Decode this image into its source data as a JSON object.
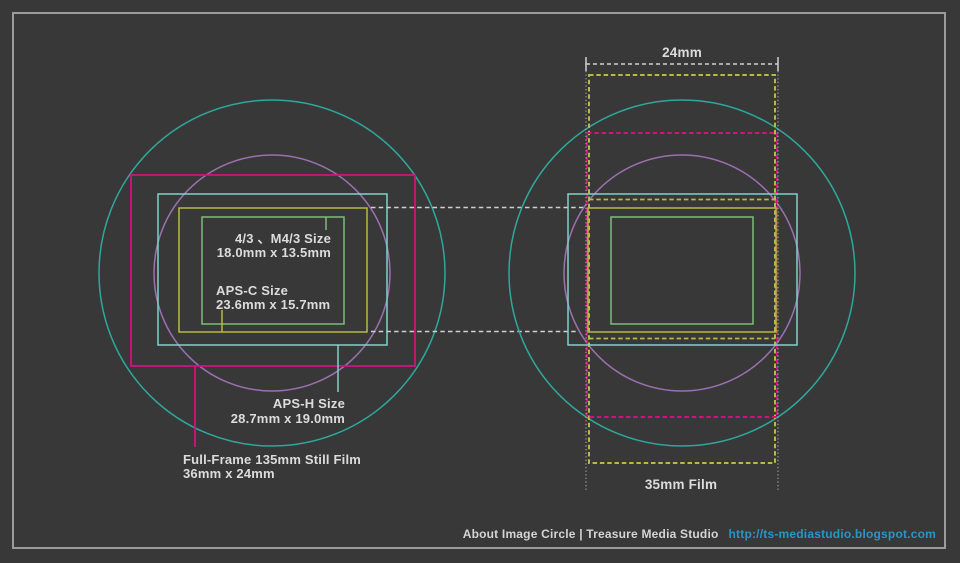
{
  "colors": {
    "background": "#383838",
    "frame": "#9b9b9b",
    "teal": "#2ea89c",
    "violet": "#9c6fb0",
    "magenta": "#d4107e",
    "cyan": "#7fd2c9",
    "yellow": "#b9b945",
    "green": "#7cbe78",
    "white_dash": "#d0d0d0",
    "dotted": "#b9b9b9",
    "text": "#dcdcdc",
    "link": "#2697c6"
  },
  "sensors": {
    "four_thirds": {
      "name": "4/3 、M4/3 Size",
      "size": "18.0mm x 13.5mm"
    },
    "aps_c": {
      "name": "APS-C Size",
      "size": "23.6mm x 15.7mm"
    },
    "aps_h": {
      "name": "APS-H Size",
      "size": "28.7mm x 19.0mm"
    },
    "full_frame": {
      "name": "Full-Frame 135mm Still Film",
      "size": "36mm x 24mm"
    }
  },
  "film": {
    "width_label": "24mm",
    "name_label": "35mm Film"
  },
  "footer": {
    "caption": "About Image Circle | Treasure Media Studio",
    "url": "http://ts-mediastudio.blogspot.com"
  }
}
